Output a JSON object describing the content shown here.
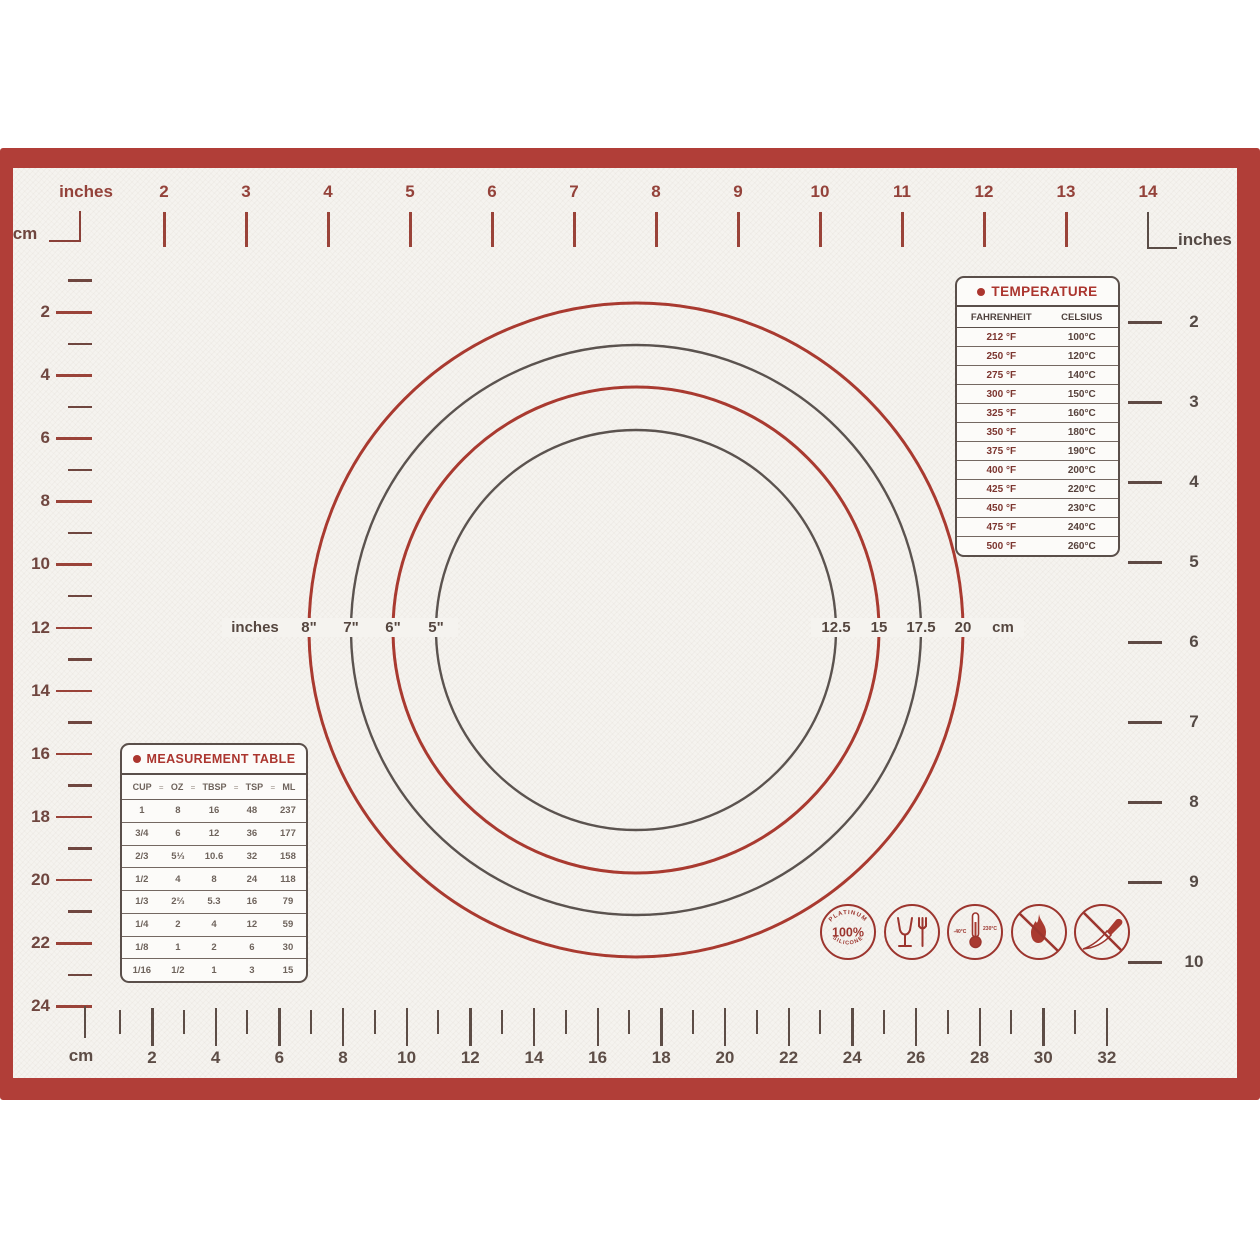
{
  "colors": {
    "frame_red": "#b13e38",
    "print_red": "#a03a31",
    "print_dark": "#5b4b45",
    "mat_ivory": "#f5f3ef",
    "circle_red": "#a93a30",
    "circle_dark": "#5b534f"
  },
  "rulers": {
    "top": {
      "unit": "inches",
      "labels": [
        "2",
        "3",
        "4",
        "5",
        "6",
        "7",
        "8",
        "9",
        "10",
        "11",
        "12",
        "13",
        "14"
      ]
    },
    "left": {
      "unit": "cm",
      "labels": [
        "2",
        "4",
        "6",
        "8",
        "10",
        "12",
        "14",
        "16",
        "18",
        "20",
        "22",
        "24"
      ]
    },
    "right": {
      "unit": "inches",
      "labels": [
        "2",
        "3",
        "4",
        "5",
        "6",
        "7",
        "8",
        "9",
        "10"
      ]
    },
    "bottom": {
      "unit": "cm",
      "labels": [
        "2",
        "4",
        "6",
        "8",
        "10",
        "12",
        "14",
        "16",
        "18",
        "20",
        "22",
        "24",
        "26",
        "28",
        "30",
        "32"
      ]
    }
  },
  "circle_gauge": {
    "left_unit": "inches",
    "right_unit": "cm",
    "rings": [
      {
        "inch": "8\"",
        "cm": "20",
        "color": "#a93a30"
      },
      {
        "inch": "7\"",
        "cm": "17.5",
        "color": "#5b534f"
      },
      {
        "inch": "6\"",
        "cm": "15",
        "color": "#a93a30"
      },
      {
        "inch": "5\"",
        "cm": "12.5",
        "color": "#5b534f"
      }
    ]
  },
  "temperature_table": {
    "title": "TEMPERATURE",
    "col_fahrenheit": "FAHRENHEIT",
    "col_celsius": "CELSIUS",
    "rows": [
      [
        "212 °F",
        "100°C"
      ],
      [
        "250 °F",
        "120°C"
      ],
      [
        "275 °F",
        "140°C"
      ],
      [
        "300 °F",
        "150°C"
      ],
      [
        "325 °F",
        "160°C"
      ],
      [
        "350 °F",
        "180°C"
      ],
      [
        "375 °F",
        "190°C"
      ],
      [
        "400 °F",
        "200°C"
      ],
      [
        "425 °F",
        "220°C"
      ],
      [
        "450 °F",
        "230°C"
      ],
      [
        "475 °F",
        "240°C"
      ],
      [
        "500 °F",
        "260°C"
      ]
    ]
  },
  "measurement_table": {
    "title": "MEASUREMENT TABLE",
    "headers": [
      "CUP",
      "OZ",
      "TBSP",
      "TSP",
      "ML"
    ],
    "separator": "=",
    "rows": [
      [
        "1",
        "8",
        "16",
        "48",
        "237"
      ],
      [
        "3/4",
        "6",
        "12",
        "36",
        "177"
      ],
      [
        "2/3",
        "5⅓",
        "10.6",
        "32",
        "158"
      ],
      [
        "1/2",
        "4",
        "8",
        "24",
        "118"
      ],
      [
        "1/3",
        "2⅔",
        "5.3",
        "16",
        "79"
      ],
      [
        "1/4",
        "2",
        "4",
        "12",
        "59"
      ],
      [
        "1/8",
        "1",
        "2",
        "6",
        "30"
      ],
      [
        "1/16",
        "1/2",
        "1",
        "3",
        "15"
      ]
    ]
  },
  "icons": {
    "silicone": {
      "top": "PLATINUM",
      "center": "100%",
      "bottom": "SILICONE"
    },
    "temp_range": {
      "min": "-40°C",
      "max": "230°C"
    }
  }
}
